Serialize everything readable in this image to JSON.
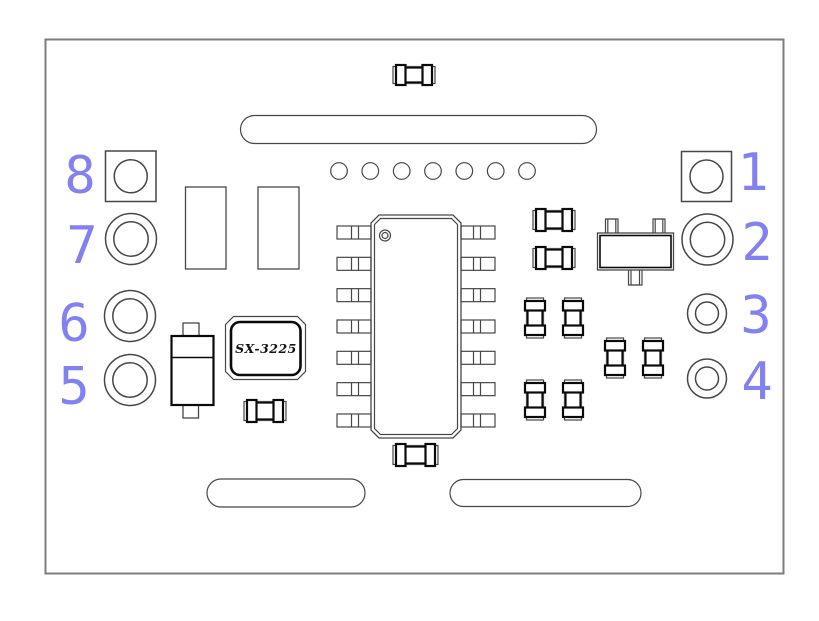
{
  "board": {
    "pads": {
      "numbers": [
        "1",
        "2",
        "3",
        "4",
        "5",
        "6",
        "7",
        "8"
      ]
    },
    "crystal": {
      "label": "SX-3225"
    },
    "colors": {
      "outline": "#474747",
      "thick_outline": "#0a0a0a",
      "board_border": "#7d7d7d",
      "pad_number_blue": "#8181f2",
      "background": "#ffffff"
    }
  }
}
